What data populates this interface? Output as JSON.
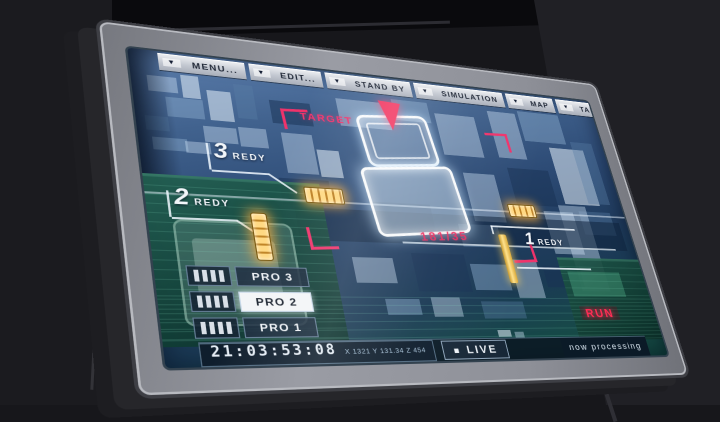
{
  "menu": {
    "items": [
      {
        "label": "MENU..."
      },
      {
        "label": "EDIT..."
      },
      {
        "label": "STAND BY"
      },
      {
        "label": "SIMULATION"
      },
      {
        "label": "MAP"
      },
      {
        "label": "TARGET"
      }
    ]
  },
  "icons": {
    "menu_arrow": "▼",
    "live_square": "■"
  },
  "target": {
    "label": "TARGET",
    "readout": "181/35"
  },
  "ready_indicators": [
    {
      "number": "3",
      "label": "REDY"
    },
    {
      "number": "2",
      "label": "REDY"
    },
    {
      "number": "1",
      "label": "REDY"
    }
  ],
  "pro_buttons": [
    {
      "label": "PRO 3",
      "active": false
    },
    {
      "label": "PRO 2",
      "active": true
    },
    {
      "label": "PRO 1",
      "active": false
    }
  ],
  "status_bar": {
    "timestamp": "21:03:53:08",
    "coordinates": "X 1321  Y 131.34  Z 454",
    "live_label": "LIVE",
    "processing_label": "now processing"
  },
  "run_indicator": {
    "label": "RUN"
  },
  "colors": {
    "accent_red": "#f0336b",
    "indicator_orange": "#ffb040",
    "screen_blue": "#2c4a74",
    "panel_green": "#16524a",
    "bezel_gray": "#8e9098"
  }
}
